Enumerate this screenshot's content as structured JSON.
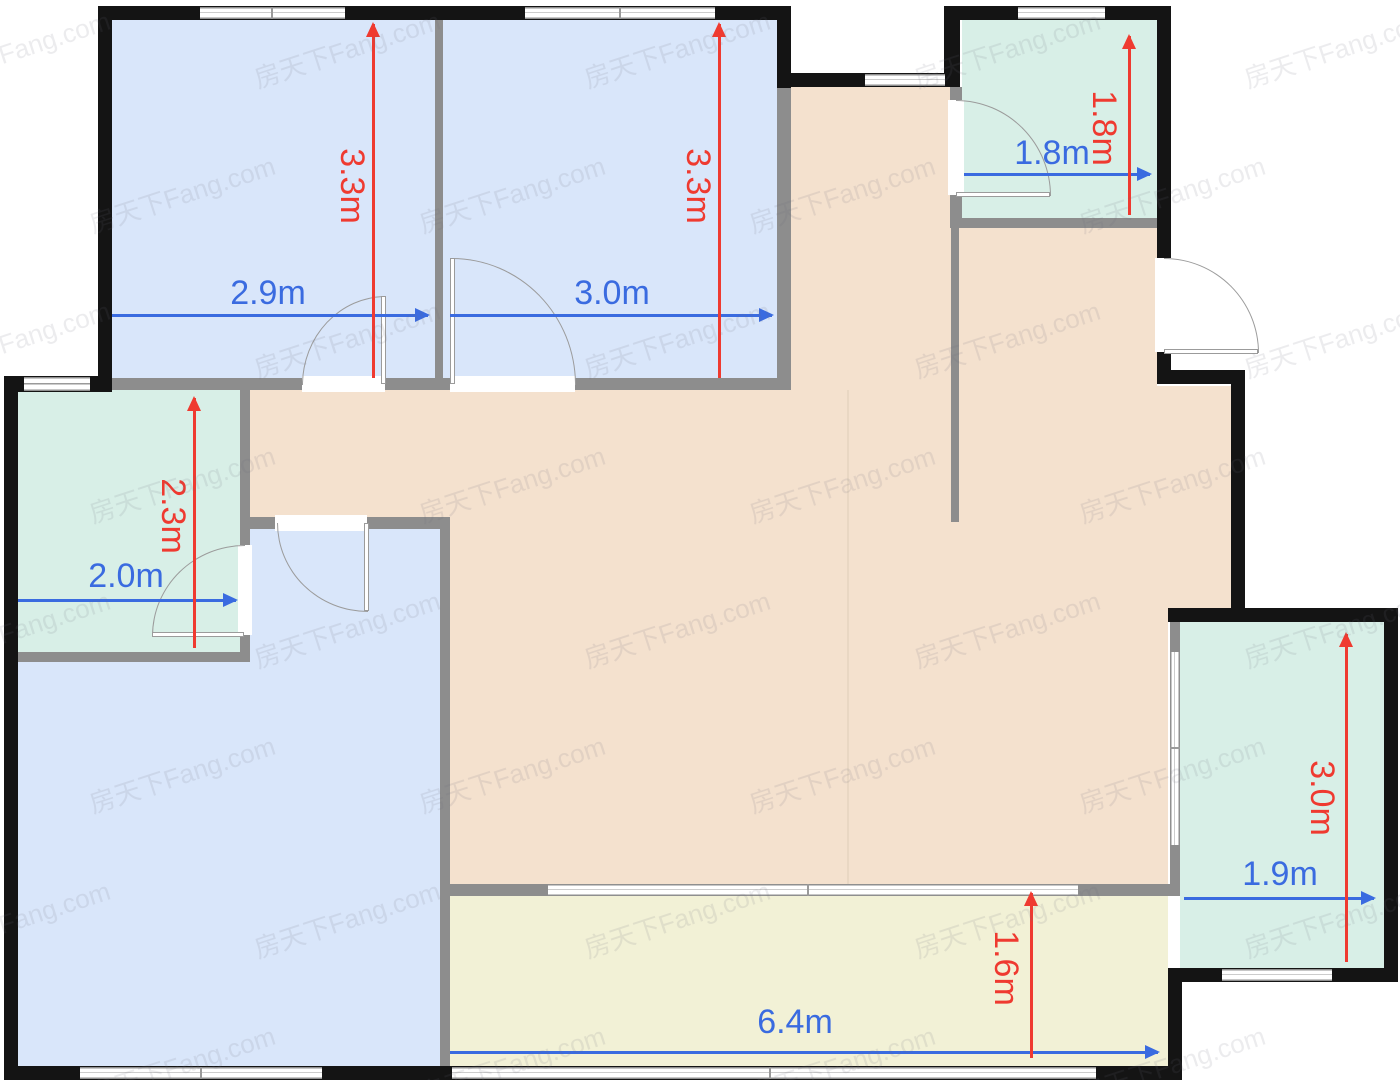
{
  "plan": {
    "watermark": "房天下Fang.com",
    "colors": {
      "bedroom_fill": "#d9e6fa",
      "bath_fill": "#d8efe7",
      "hall_fill": "#f4e1ce",
      "balcony_fill": "#f2f1d6",
      "exterior_wall": "#141414",
      "interior_wall": "#8d8d8d",
      "dim_blue": "#3a6be0",
      "dim_red": "#ef3a30"
    },
    "dims": {
      "bedroom1_w": "2.9m",
      "bedroom1_h": "3.3m",
      "bedroom2_w": "3.0m",
      "bedroom2_h": "3.3m",
      "bath_top_w": "1.8m",
      "bath_top_h": "1.8m",
      "bath_left_w": "2.0m",
      "bath_left_h": "2.3m",
      "room_right_w": "1.9m",
      "room_right_h": "3.0m",
      "balcony_w": "6.4m",
      "balcony_h": "1.6m"
    }
  }
}
